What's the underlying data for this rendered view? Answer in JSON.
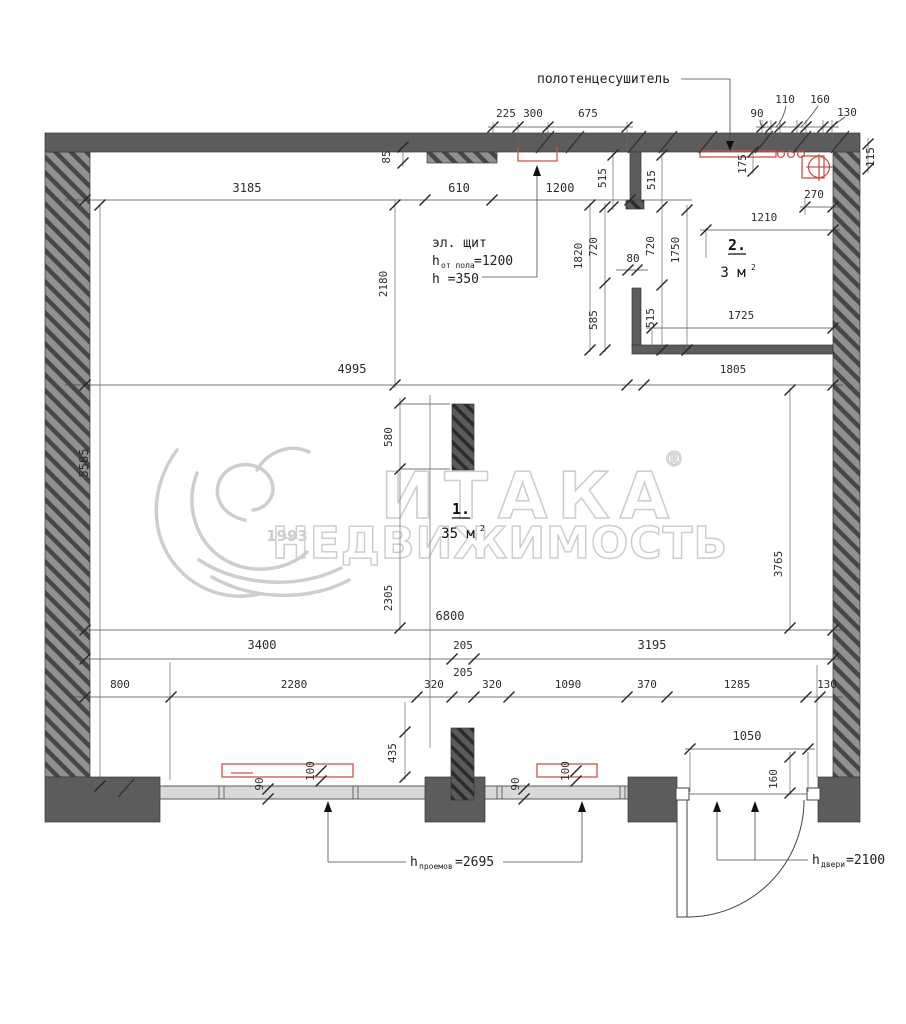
{
  "colors": {
    "wall_solid": "#5c5c5c",
    "wall_hatch_bg": "#919191",
    "wall_hatch_stripe": "#474747",
    "column_bg": "#5a5a5a",
    "column_stripe": "#2e2e2e",
    "window_band": "#d9d9d9",
    "fixture_red": "#c9544c",
    "watermark_gray": "#c9c9c9"
  },
  "watermark": {
    "brand": "ИТАКА",
    "registered": "®",
    "subtitle": "НЕДВИЖИМОСТЬ",
    "year": "1993"
  },
  "rooms": [
    {
      "number": "1.",
      "area": "35 м",
      "area_sup": "2"
    },
    {
      "number": "2.",
      "area": "3 м",
      "area_sup": "2"
    }
  ],
  "labels": {
    "towel_dryer": "полотенцесушитель",
    "el_panel_title": "эл. щит",
    "el_panel_h1_prefix": "h",
    "el_panel_h1_sub": "от пола",
    "el_panel_h1_value": "=1200",
    "el_panel_h2": "h =350",
    "openings_prefix": "h",
    "openings_sub": "проемов",
    "openings_value": "=2695",
    "door_prefix": "h",
    "door_sub": "двери",
    "door_value": "=2100"
  },
  "dims": {
    "top_225": "225",
    "top_300": "300",
    "top_675": "675",
    "tr_90": "90",
    "tr_110": "110",
    "tr_160": "160",
    "tr_130": "130",
    "tr_115": "115",
    "row1_3185": "3185",
    "row1_85": "85",
    "row1_610": "610",
    "row1_1200": "1200",
    "bath_515a": "515",
    "bath_515b": "515",
    "bath_175": "175",
    "bath_270": "270",
    "bath_1210": "1210",
    "bath_1820": "1820",
    "bath_720a": "720",
    "bath_80": "80",
    "bath_720b": "720",
    "bath_1750": "1750",
    "bath_585": "585",
    "bath_515c": "515",
    "bath_1725": "1725",
    "bath_1805": "1805",
    "mid_4995": "4995",
    "left_5585": "5585",
    "left_2180": "2180",
    "col_580": "580",
    "mid_2305": "2305",
    "right_3765": "3765",
    "row_6800": "6800",
    "row_3400": "3400",
    "row_205a": "205",
    "row_3195": "3195",
    "row_800": "800",
    "row_2280": "2280",
    "row_320a": "320",
    "row_205b": "205",
    "row_320b": "320",
    "row_1090": "1090",
    "row_370": "370",
    "row_1285": "1285",
    "row_130a": "130",
    "bot_435": "435",
    "rad1_90": "90",
    "rad1_100": "100",
    "rad2_90": "90",
    "rad2_100": "100",
    "door_1050": "1050",
    "door_160": "160"
  }
}
